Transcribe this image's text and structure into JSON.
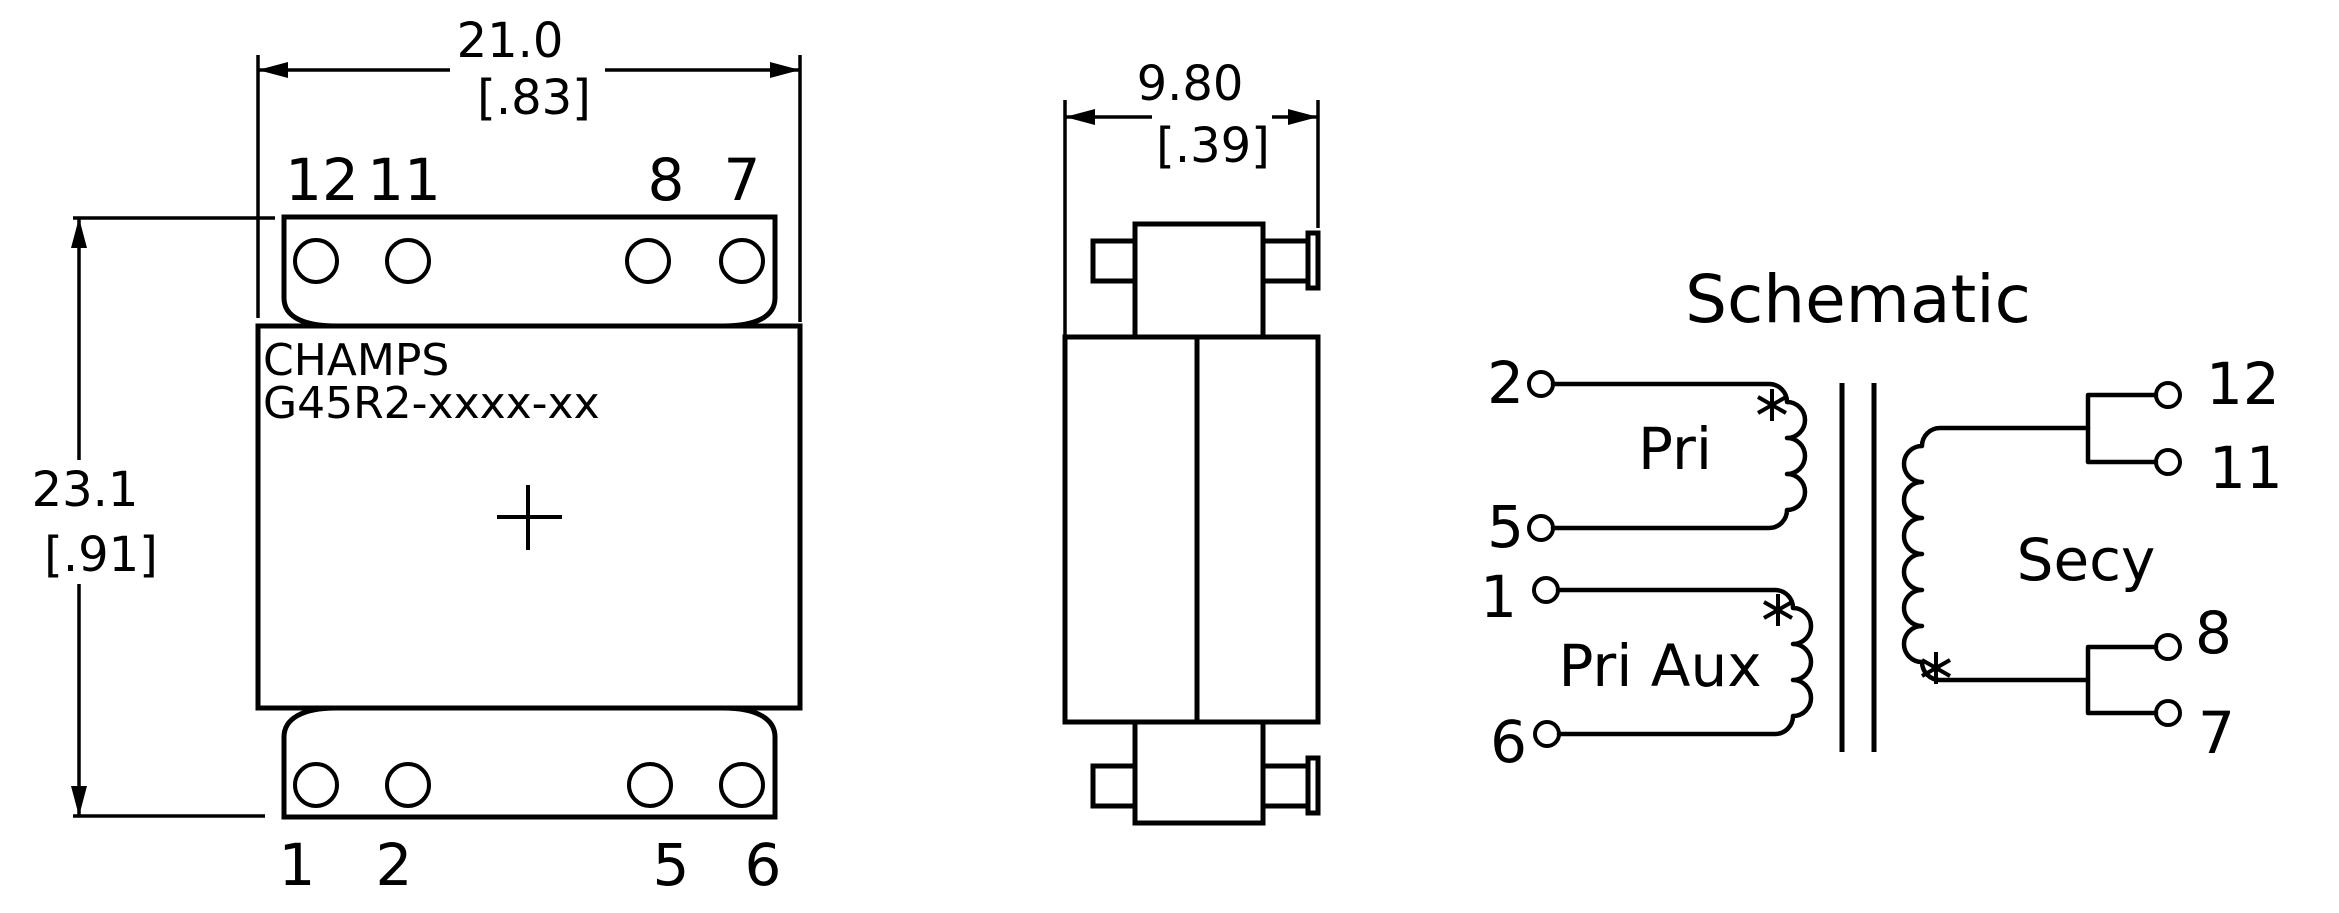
{
  "front_view": {
    "pin_labels_top": [
      "12",
      "11",
      "8",
      "7"
    ],
    "pin_labels_bottom": [
      "1",
      "2",
      "5",
      "6"
    ],
    "marking_line1": "CHAMPS",
    "marking_line2": "G45R2-xxxx-xx",
    "dim_width": {
      "metric": "21.0",
      "imperial": "[.83]"
    },
    "dim_height": {
      "metric": "23.1",
      "imperial": "[.91]"
    }
  },
  "side_view": {
    "dim_depth": {
      "metric": "9.80",
      "imperial": "[.39]"
    }
  },
  "schematic": {
    "title": "Schematic",
    "primary": {
      "label": "Pri",
      "pin_start": "2",
      "pin_finish": "5"
    },
    "primary_aux": {
      "label": "Pri Aux",
      "pin_start": "1",
      "pin_finish": "6"
    },
    "secondary": {
      "label": "Secy",
      "pin_labels": [
        "12",
        "11",
        "8",
        "7"
      ]
    },
    "polarity_marker": "*"
  },
  "colors": {
    "line": "#000000",
    "background": "#ffffff"
  }
}
